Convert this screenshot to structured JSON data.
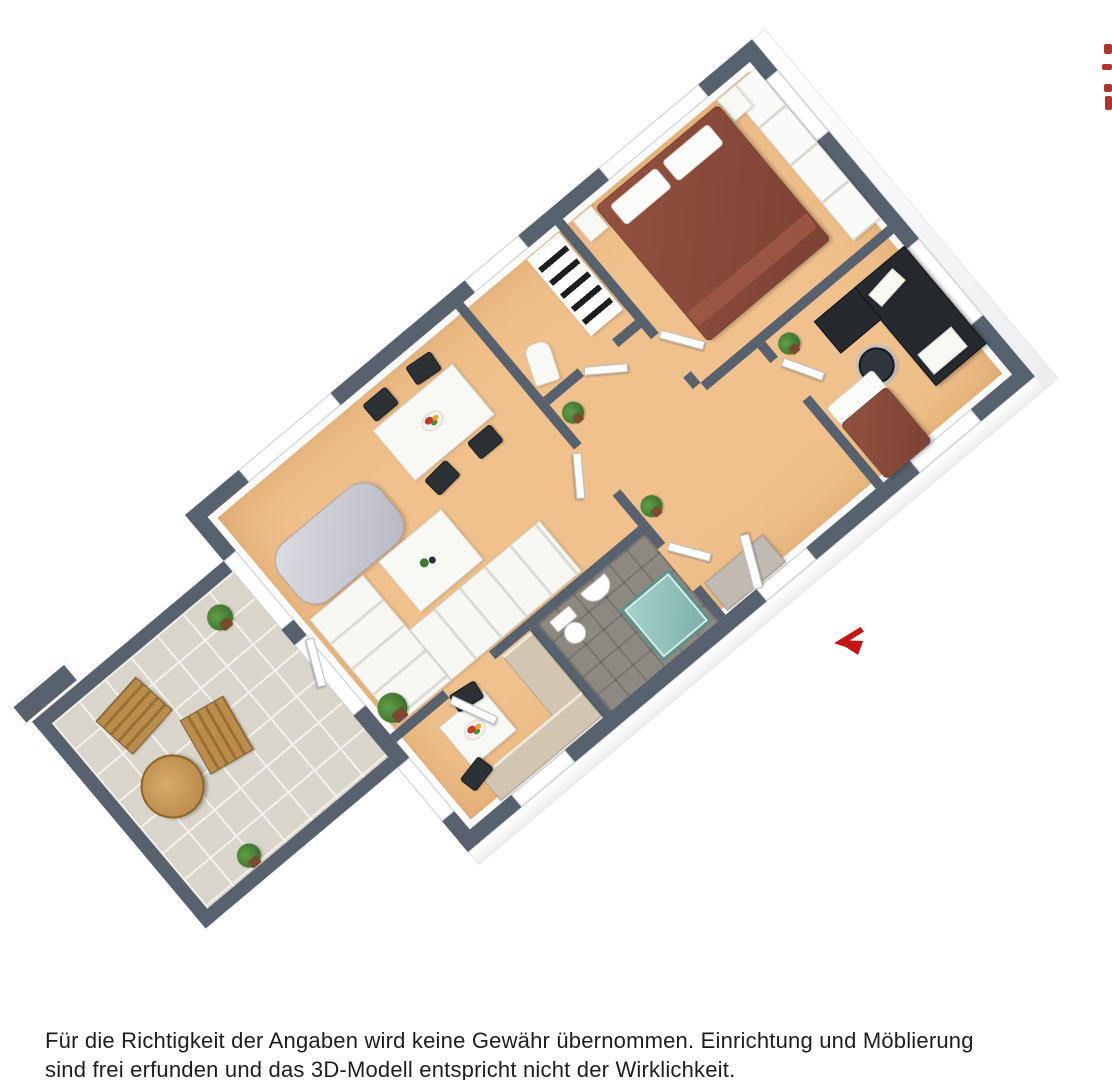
{
  "page": {
    "width": 1112,
    "height": 1080,
    "background": "#ffffff"
  },
  "disclaimer": {
    "line1": "Für die Richtigkeit der Angaben wird keine Gewähr übernommen. Einrichtung und Möblierung",
    "line2": "sind frei erfunden und das 3D-Modell entspricht nicht der Wirklichkeit."
  },
  "plan": {
    "type": "3d-floorplan-top-view",
    "rotation_deg": -40,
    "colors": {
      "wall_top": "#57626e",
      "wall_face": "#fcfcfc",
      "floor": "#f0c18c",
      "balcony_tile": "#d9d5ca",
      "tile_grout": "#f3f1ea",
      "bath_floor": "#8d8880",
      "shower": "#8fc2ba",
      "bed": "#8a4a3a",
      "desk": "#26292e",
      "chair_dark": "#2c3136",
      "sofa_white": "#f7f7f4",
      "chaise_silver": "#c3c4cd",
      "wood_furniture": "#b68848",
      "counter": "#d2c6b2",
      "plant_green": "#3f7a35",
      "entrance_arrow": "#c41414",
      "watermark_red": "#b23230",
      "text": "#1d1d1d"
    },
    "rooms": [
      {
        "id": "bedroom",
        "furniture": [
          "double-bed",
          "two-pillows",
          "two-nightstands",
          "wardrobe-row",
          "window"
        ]
      },
      {
        "id": "office",
        "furniture": [
          "desk",
          "office-chair",
          "printer",
          "monitor",
          "single-bed",
          "plant",
          "window"
        ]
      },
      {
        "id": "storage-room",
        "furniture": [
          "bookshelf",
          "ironing-board"
        ]
      },
      {
        "id": "living-room",
        "furniture": [
          "sectional-sofa",
          "silver-chaise",
          "coffee-table",
          "dining-table",
          "four-chairs",
          "fruit-bowl",
          "plant"
        ]
      },
      {
        "id": "hallway",
        "furniture": [
          "open-doors",
          "two-plants",
          "sideboard"
        ]
      },
      {
        "id": "bathroom",
        "furniture": [
          "toilet",
          "sink",
          "shower-teal"
        ]
      },
      {
        "id": "kitchen",
        "furniture": [
          "l-counter",
          "small-table",
          "two-chairs",
          "fruit-plate",
          "window"
        ]
      },
      {
        "id": "balcony",
        "furniture": [
          "two-wooden-chairs",
          "round-wood-table",
          "two-plants",
          "tiled-floor"
        ]
      }
    ],
    "entrance_arrow": {
      "direction": "left",
      "color": "#c41414"
    },
    "watermark_fragments": {
      "position": "top-right-edge",
      "color": "#b23230",
      "count": 4
    }
  }
}
